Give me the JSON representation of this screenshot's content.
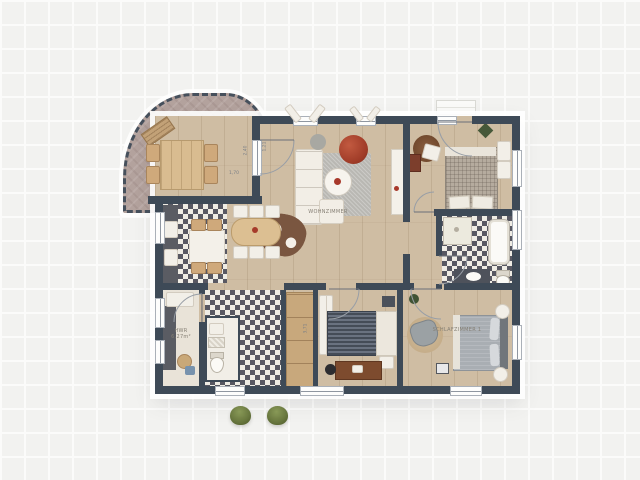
{
  "scene": {
    "type": "floor-plan"
  },
  "rooms": {
    "living": {
      "label": "WOHNZIMMER"
    },
    "bedroom1": {
      "label": "SCHLAFZIMMER 1"
    },
    "utility": {
      "label": "HWR",
      "area": "6,27m²"
    }
  },
  "dimensions": {
    "terrace_width": "1,70",
    "terrace_depth": "2,40",
    "door_width": "1,21",
    "room_depth": "3,71"
  },
  "colors": {
    "wall": "#3E4A57",
    "wood_floor": "#CFBDA3",
    "terrace_floor": "#B3A29D",
    "checker_dark": "#585862",
    "checker_light": "#EFECE4",
    "accent_red": "#B5452F",
    "rug_gray": "#B8B7B2",
    "bush_green": "#66743A"
  }
}
